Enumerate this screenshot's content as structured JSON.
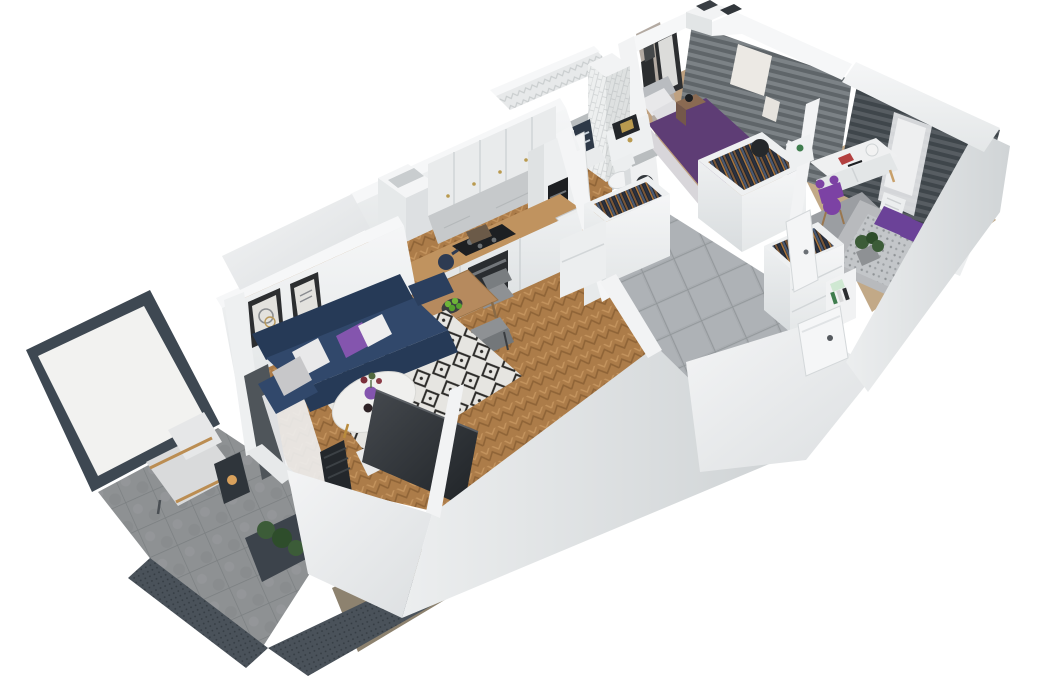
{
  "scene": {
    "type": "3d-cutaway-floorplan-render",
    "description": "Isometric cutaway 3D render of a two-bedroom apartment with open kitchen-living room, hallway, bathroom and balcony on a white background",
    "background": "#ffffff"
  },
  "palette": {
    "wall_top": "#f6f7f8",
    "wall_face": "#e9ebec",
    "wall_shade": "#d6dadc",
    "wall_dark": "#c2c7ca",
    "interior_beige": "#b3aaa2",
    "wood_floor": "#ac7c49",
    "wood_counter": "#c0935f",
    "wood_table": "#b68a5e",
    "tile_hall": "#a8acb0",
    "tile_balcony": "#8e9193",
    "sofa_navy": "#31486b",
    "sofa_navy_dark": "#263a57",
    "pillow_white": "#e9e9ea",
    "pillow_gray": "#c7c7c9",
    "accent_purple": "#8455ae",
    "rug_base": "#e6e5e1",
    "rug_black": "#2c2b29",
    "bed1_purple": "#5e3d75",
    "bed2_purple": "#6b4298",
    "chair_purple": "#7c42a4",
    "curtain_gray": "#81878b",
    "curtain_dark": "#4f555a",
    "window_light": "#ece9e4",
    "appliance_black": "#1d1f22",
    "plant_green": "#3c5c38",
    "gold": "#b99a4f",
    "balcony_frame": "#3e4852"
  },
  "rooms": {
    "balcony": {
      "label": "Balcony",
      "items": [
        "frosted glass privacy screen",
        "gray stone tile floor",
        "perforated metal railing",
        "lounge chair",
        "candle lantern",
        "planter with greenery",
        "wicker mat",
        "dark privacy curtain"
      ]
    },
    "living_room": {
      "label": "Living room",
      "items": [
        "navy three-seat sofa",
        "white knit pillows",
        "gray pillow",
        "purple pillow",
        "round white coffee table with gold legs",
        "purple vase with flowers",
        "two candle holders",
        "black and white diamond rug",
        "flat TV leaning on front wall",
        "white media stand",
        "two framed artworks",
        "sheer and dark curtains",
        "herringbone oak floor"
      ]
    },
    "dining_area": {
      "label": "Dining area",
      "items": [
        "wooden dining table",
        "four gray chairs",
        "plate of green apples"
      ]
    },
    "kitchen": {
      "label": "Kitchen",
      "items": [
        "white panel upper cabinets with brass knobs",
        "tall cabinet with coffee machine",
        "gray marble backsplash",
        "wood countertop",
        "black cooktop",
        "built-in oven",
        "kettle",
        "white sink with brass faucet",
        "lower cabinets",
        "boxed vent shaft"
      ]
    },
    "bathroom": {
      "label": "Bathroom",
      "items": [
        "chevron tile wall",
        "subway tile column",
        "shower nook with navy towels",
        "white vanity",
        "brass flush plate",
        "wall-hung toilet",
        "washing machine",
        "open white door"
      ]
    },
    "hallway": {
      "label": "Hallway",
      "items": [
        "gray porcelain tile floor",
        "closet with open clothes rail",
        "wardrobe with drawers and clothes rail",
        "shelf with books and shoe box",
        "interior door ajar",
        "entrance door with handle"
      ]
    },
    "bedroom_main": {
      "label": "Main bedroom",
      "items": [
        "double bed with purple duvet",
        "gray headboard and white pillows",
        "wood nightstand with black lamp",
        "three framed pictures",
        "gray pleated curtains",
        "bright windows",
        "white radiator",
        "wardrobe with clothes rail",
        "black accent chair"
      ]
    },
    "bedroom_second": {
      "label": "Second bedroom",
      "items": [
        "white desk with drawers",
        "desk accessories and sphere lamp",
        "purple bunny-ear chair",
        "gray shag rug",
        "bed with patterned gray duvet",
        "purple pillows",
        "white side unit",
        "dark curtains with white sheer",
        "potted plant",
        "shelf with books",
        "white radiator"
      ]
    },
    "roof": {
      "label": "Roof edge",
      "items": [
        "vent shaft block",
        "two dark roof vents"
      ]
    }
  }
}
